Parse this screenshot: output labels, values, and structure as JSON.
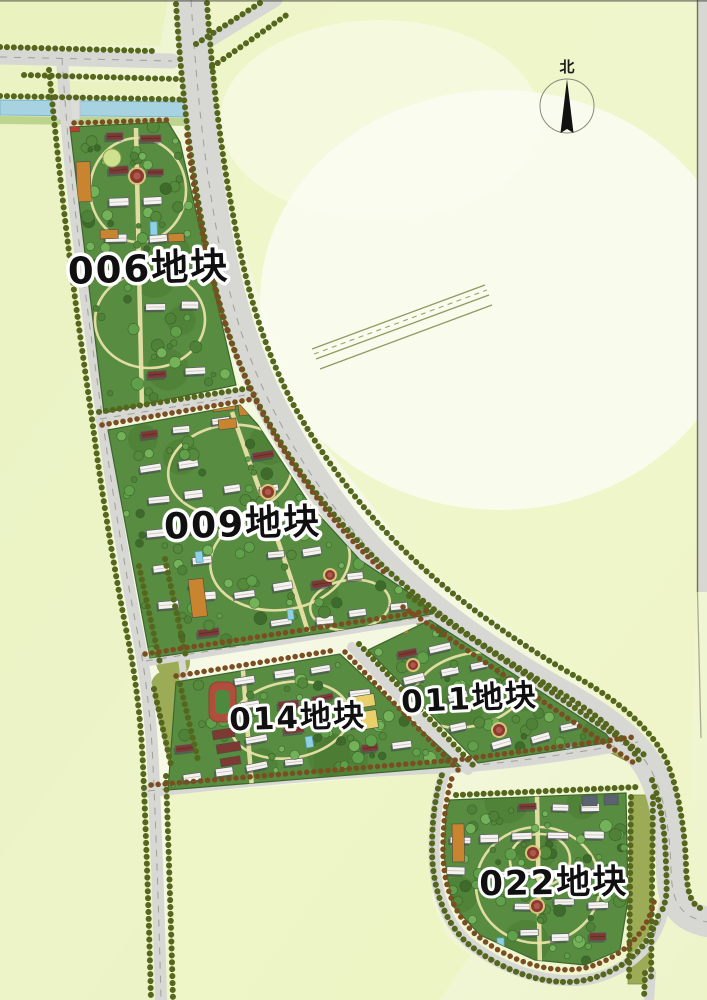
{
  "map": {
    "north_label": "北",
    "parcels": [
      {
        "id": "006",
        "label": "006地块"
      },
      {
        "id": "009",
        "label": "009地块"
      },
      {
        "id": "014",
        "label": "014地块"
      },
      {
        "id": "011",
        "label": "011地块"
      },
      {
        "id": "022",
        "label": "022地块"
      }
    ]
  },
  "colors": {
    "background": "#f1f6d8",
    "road": "#d7d7d3",
    "road_centerline": "#a0a098",
    "canal": "#a6d2e2",
    "canal_edge": "#7fb5ca",
    "bank_green": "#bcd48d",
    "parcel_green": "#578c41",
    "parcel_edge": "#3e672c",
    "verge_olive": "#9cab56",
    "tree_olive": "#55661d",
    "tree_brown": "#7b4e22",
    "path_beige": "#e9e2a8",
    "building_white": "#f5f3ef",
    "building_maroon": "#7c3a33",
    "orange_building": "#c8842f",
    "track_red": "#b14d3c",
    "track_infield": "#4e8a3e",
    "pool_blue": "#8fd0e4",
    "plaza_red": "#8a3a30",
    "plaza_ring": "#dcc47c",
    "court_orange": "#d3913f",
    "school_yellow": "#e8d06a",
    "slate_building": "#5a6470",
    "label_text": "#101010",
    "label_outline": "#ffffff"
  }
}
